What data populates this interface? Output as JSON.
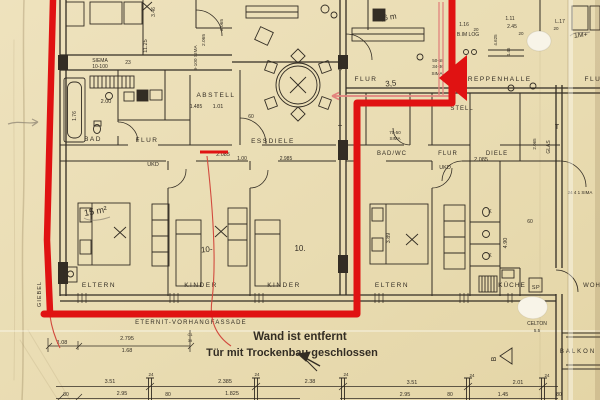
{
  "colors": {
    "paper": "#e9dcb2",
    "paper_light": "#f0e7ca",
    "paper_dark": "#dcce9f",
    "ink": "#332d24",
    "red_marker": "#e01212",
    "red_text": "#bf4038",
    "pink": "#e2837d",
    "pencil": "#8f8674",
    "white": "#f8f4e8"
  },
  "annotations": {
    "wall_removed": "Wand ist entfernt",
    "door_closed": "Tür mit Trockenbau geschlossen"
  },
  "facade_label": "ETERNIT-VORHANGFASSADE",
  "gable_label": "GIEBEL",
  "labels": [
    {
      "t": "BAD",
      "x": 93,
      "y": 141,
      "s": 6.5,
      "ls": 1.5
    },
    {
      "t": "FLUR",
      "x": 147,
      "y": 142,
      "s": 6.5,
      "ls": 1.5
    },
    {
      "t": "ABSTELL",
      "x": 216,
      "y": 97,
      "s": 6.5,
      "ls": 1.5
    },
    {
      "t": "ESSDIELE",
      "x": 273,
      "y": 143,
      "s": 6.5,
      "ls": 1.5
    },
    {
      "t": "ELTERN",
      "x": 99,
      "y": 287,
      "s": 6.5,
      "ls": 1.5
    },
    {
      "t": "KINDER",
      "x": 201,
      "y": 287,
      "s": 6.5,
      "ls": 1.5
    },
    {
      "t": "KINDER",
      "x": 284,
      "y": 287,
      "s": 6.5,
      "ls": 1.5
    },
    {
      "t": "FLUR",
      "x": 366,
      "y": 81,
      "s": 6.5,
      "ls": 1.5
    },
    {
      "t": "TREPPENHALLE",
      "x": 497,
      "y": 81,
      "s": 6.5,
      "ls": 1.5
    },
    {
      "t": "FLUR",
      "x": 596,
      "y": 81,
      "s": 6.5,
      "ls": 1.5
    },
    {
      "t": "BAD/WC",
      "x": 392,
      "y": 155,
      "s": 6,
      "ls": 1
    },
    {
      "t": "FLUR",
      "x": 448,
      "y": 155,
      "s": 6,
      "ls": 1
    },
    {
      "t": "DIELE",
      "x": 497,
      "y": 155,
      "s": 6,
      "ls": 1
    },
    {
      "t": "STELL",
      "x": 462,
      "y": 110,
      "s": 6,
      "ls": 1
    },
    {
      "t": "ELTERN",
      "x": 392,
      "y": 287,
      "s": 6.5,
      "ls": 1.5
    },
    {
      "t": "KÜCHE",
      "x": 512,
      "y": 287,
      "s": 6.5,
      "ls": 1
    },
    {
      "t": "SP",
      "x": 536,
      "y": 289,
      "s": 5.5,
      "ls": 0.5
    },
    {
      "t": "BALKON",
      "x": 578,
      "y": 353,
      "s": 6,
      "ls": 2
    },
    {
      "t": "WOH",
      "x": 592,
      "y": 287,
      "s": 6,
      "ls": 1
    },
    {
      "t": "UKD",
      "x": 153,
      "y": 166,
      "s": 5.5
    },
    {
      "t": "UKD",
      "x": 445,
      "y": 169,
      "s": 5.5
    },
    {
      "t": "SIEMA",
      "x": 100,
      "y": 62,
      "s": 5
    },
    {
      "t": "10-100",
      "x": 100,
      "y": 68,
      "s": 5
    },
    {
      "t": "23",
      "x": 128,
      "y": 64,
      "s": 5
    },
    {
      "t": "11.25",
      "x": 147,
      "y": 46,
      "s": 5.5,
      "r": -90
    },
    {
      "t": "3.46",
      "x": 155,
      "y": 12,
      "s": 5,
      "r": -90
    },
    {
      "t": "9-100 SIMA",
      "x": 197,
      "y": 58,
      "s": 4.8,
      "r": -90
    },
    {
      "t": "2.065",
      "x": 205,
      "y": 40,
      "s": 4.8,
      "r": -90
    },
    {
      "t": "2.065",
      "x": 223,
      "y": 25,
      "s": 4.8,
      "r": -90
    },
    {
      "t": "2.00",
      "x": 106,
      "y": 103,
      "s": 5.5
    },
    {
      "t": "1.76",
      "x": 76,
      "y": 116,
      "s": 5,
      "r": -90
    },
    {
      "t": "1.485",
      "x": 196,
      "y": 108,
      "s": 5
    },
    {
      "t": "1.01",
      "x": 218,
      "y": 108,
      "s": 5.5
    },
    {
      "t": "60",
      "x": 251,
      "y": 118,
      "s": 5
    },
    {
      "t": "2.085",
      "x": 223,
      "y": 156,
      "s": 5.5
    },
    {
      "t": "1.00",
      "x": 242,
      "y": 160,
      "s": 5
    },
    {
      "t": "2.985",
      "x": 286,
      "y": 160,
      "s": 5
    },
    {
      "t": "2.085",
      "x": 481,
      "y": 161,
      "s": 5.5
    },
    {
      "t": "GLAS",
      "x": 342,
      "y": 64,
      "s": 5,
      "r": -90
    },
    {
      "t": "GLAS",
      "x": 550,
      "y": 147,
      "s": 5,
      "r": -90
    },
    {
      "t": "T",
      "x": 340,
      "y": 130,
      "s": 7
    },
    {
      "t": "T",
      "x": 557,
      "y": 129,
      "s": 7
    },
    {
      "t": "1.16",
      "x": 464,
      "y": 26,
      "s": 5
    },
    {
      "t": "20",
      "x": 476,
      "y": 31,
      "s": 4.5
    },
    {
      "t": "1.11",
      "x": 510,
      "y": 20,
      "s": 5
    },
    {
      "t": "2.45",
      "x": 512,
      "y": 28,
      "s": 5
    },
    {
      "t": "20",
      "x": 521,
      "y": 35,
      "s": 4.5
    },
    {
      "t": "L.17",
      "x": 560,
      "y": 23,
      "s": 5
    },
    {
      "t": "20",
      "x": 556,
      "y": 30,
      "s": 4.5
    },
    {
      "t": "B.IM LOG",
      "x": 468,
      "y": 36,
      "s": 5
    },
    {
      "t": "4.625",
      "x": 497,
      "y": 40,
      "s": 4.5,
      "r": -90
    },
    {
      "t": "4.45",
      "x": 510,
      "y": 52,
      "s": 4.5,
      "r": -90
    },
    {
      "t": "50-58",
      "x": 438,
      "y": 62,
      "s": 4.5
    },
    {
      "t": "34-36",
      "x": 438,
      "y": 68,
      "s": 4.5
    },
    {
      "t": "SIMA",
      "x": 437,
      "y": 75,
      "s": 4.5
    },
    {
      "t": "70-50",
      "x": 395,
      "y": 134,
      "s": 4.5
    },
    {
      "t": "SIMA",
      "x": 395,
      "y": 140,
      "s": 4.5
    },
    {
      "t": "3.89",
      "x": 390,
      "y": 238,
      "s": 5.5,
      "r": -90
    },
    {
      "t": "4.90",
      "x": 507,
      "y": 243,
      "s": 5.5,
      "r": -90
    },
    {
      "t": "60",
      "x": 530,
      "y": 223,
      "s": 5
    },
    {
      "t": "K",
      "x": 490,
      "y": 213,
      "s": 5
    },
    {
      "t": "K",
      "x": 490,
      "y": 257,
      "s": 5
    },
    {
      "t": "2.065",
      "x": 536,
      "y": 144,
      "s": 4.5,
      "r": -90
    },
    {
      "t": "CELTON",
      "x": 537,
      "y": 325,
      "s": 5
    },
    {
      "t": "5.5",
      "x": 537,
      "y": 332,
      "s": 4.5
    },
    {
      "t": "24 4 1 SIMA",
      "x": 580,
      "y": 194,
      "s": 4.5
    },
    {
      "t": "B",
      "x": 496,
      "y": 359,
      "s": 7,
      "r": -90
    },
    {
      "t": "1.08",
      "x": 62,
      "y": 344,
      "s": 5.5
    },
    {
      "t": "2.795",
      "x": 127,
      "y": 340,
      "s": 5.5
    },
    {
      "t": "1.68",
      "x": 127,
      "y": 352,
      "s": 5.5
    },
    {
      "t": "C1",
      "x": 190,
      "y": 336,
      "s": 4
    },
    {
      "t": "39",
      "x": 190,
      "y": 342,
      "s": 4
    },
    {
      "t": "80",
      "x": 66,
      "y": 396,
      "s": 5
    },
    {
      "t": "3.51",
      "x": 110,
      "y": 383,
      "s": 5.5
    },
    {
      "t": "2.95",
      "x": 122,
      "y": 395,
      "s": 5.5
    },
    {
      "t": "80",
      "x": 168,
      "y": 396,
      "s": 5
    },
    {
      "t": "24",
      "x": 151,
      "y": 376,
      "s": 4.5
    },
    {
      "t": "2.385",
      "x": 225,
      "y": 383,
      "s": 5.5
    },
    {
      "t": "1.825",
      "x": 232,
      "y": 395,
      "s": 5.5
    },
    {
      "t": "24",
      "x": 257,
      "y": 376,
      "s": 4.5
    },
    {
      "t": "2.38",
      "x": 310,
      "y": 383,
      "s": 5.5
    },
    {
      "t": "24",
      "x": 346,
      "y": 376,
      "s": 4.5
    },
    {
      "t": "3.51",
      "x": 412,
      "y": 384,
      "s": 5.5
    },
    {
      "t": "2.95",
      "x": 405,
      "y": 396,
      "s": 5.5
    },
    {
      "t": "80",
      "x": 450,
      "y": 396,
      "s": 5
    },
    {
      "t": "24",
      "x": 472,
      "y": 377,
      "s": 4.5
    },
    {
      "t": "2.01",
      "x": 518,
      "y": 384,
      "s": 5.5
    },
    {
      "t": "1.45",
      "x": 503,
      "y": 396,
      "s": 5.5
    },
    {
      "t": "24",
      "x": 547,
      "y": 377,
      "s": 4.5
    },
    {
      "t": "80",
      "x": 559,
      "y": 396,
      "s": 5
    },
    {
      "t": "15 m²",
      "x": 96,
      "y": 214,
      "s": 9,
      "r": -10,
      "c": "pencil"
    },
    {
      "t": "7,6 m",
      "x": 387,
      "y": 20,
      "s": 8,
      "r": -8,
      "c": "pencil"
    },
    {
      "t": "3,5",
      "x": 391,
      "y": 86,
      "s": 8,
      "r": -5,
      "c": "pencil"
    },
    {
      "t": "10-",
      "x": 207,
      "y": 252,
      "s": 8,
      "r": -5,
      "c": "pencil"
    },
    {
      "t": "10.",
      "x": 300,
      "y": 251,
      "s": 8,
      "c": "pencil"
    },
    {
      "t": "1M+",
      "x": 581,
      "y": 37,
      "s": 7,
      "r": -5,
      "c": "pencil"
    }
  ]
}
